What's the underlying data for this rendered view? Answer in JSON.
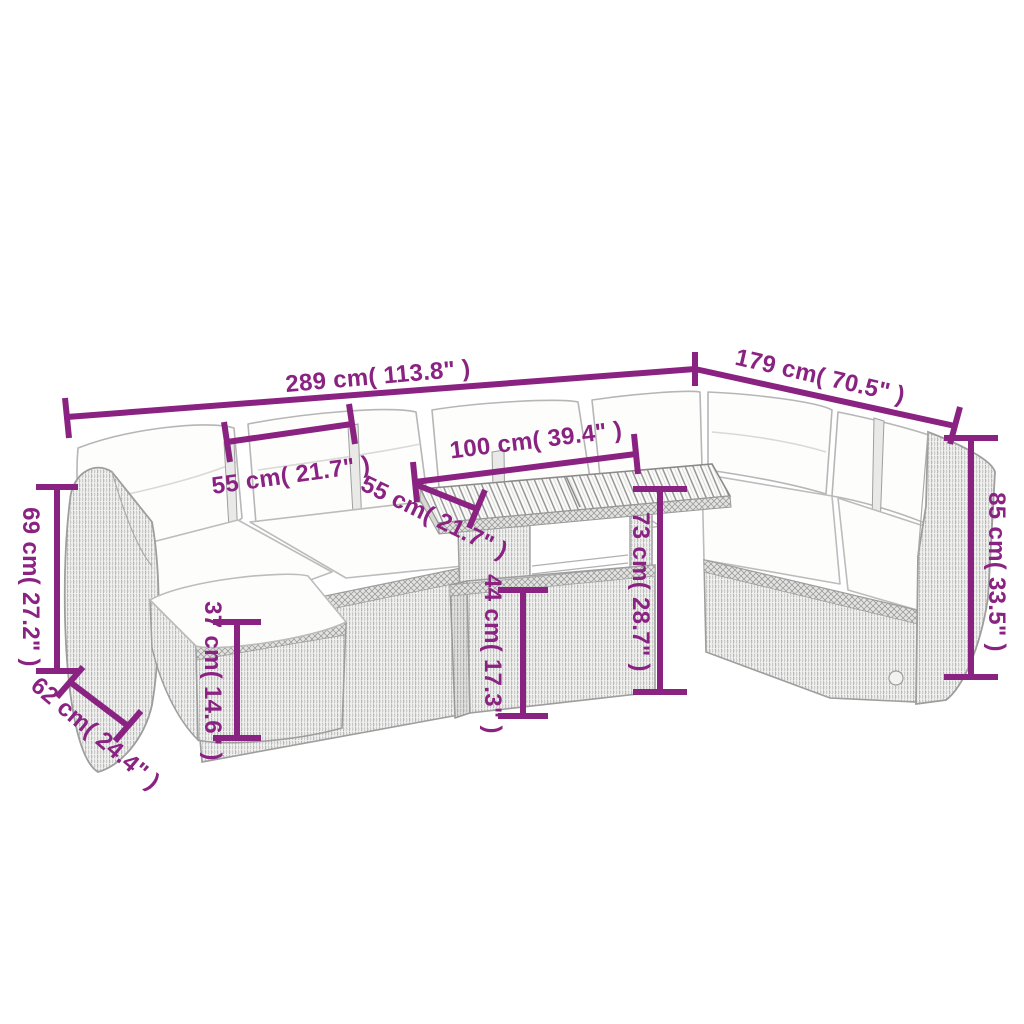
{
  "page": {
    "background": "#ffffff"
  },
  "diagram": {
    "accent_color": "#8a2282",
    "line_art_color": "#a6a6a6",
    "cushion_color": "#fdfdfc",
    "dimensions": {
      "width_total": {
        "label": "289 cm( 113.8\" )"
      },
      "depth_total": {
        "label": "179 cm( 70.5\" )"
      },
      "cushion_width": {
        "label": "55 cm( 21.7\" )"
      },
      "table_length": {
        "label": "100 cm( 39.4\" )"
      },
      "table_depth": {
        "label": "55 cm( 21.7\" )"
      },
      "table_height": {
        "label": "73 cm( 28.7\" )"
      },
      "table_base_height": {
        "label": "44 cm( 17.3\" )"
      },
      "armrest_height": {
        "label": "69 cm( 27.2\" )"
      },
      "seat_depth": {
        "label": "62 cm( 24.4\" )"
      },
      "seat_height": {
        "label": "37 cm( 14.6\" )"
      },
      "back_height": {
        "label": "85 cm( 33.5\" )"
      }
    }
  }
}
